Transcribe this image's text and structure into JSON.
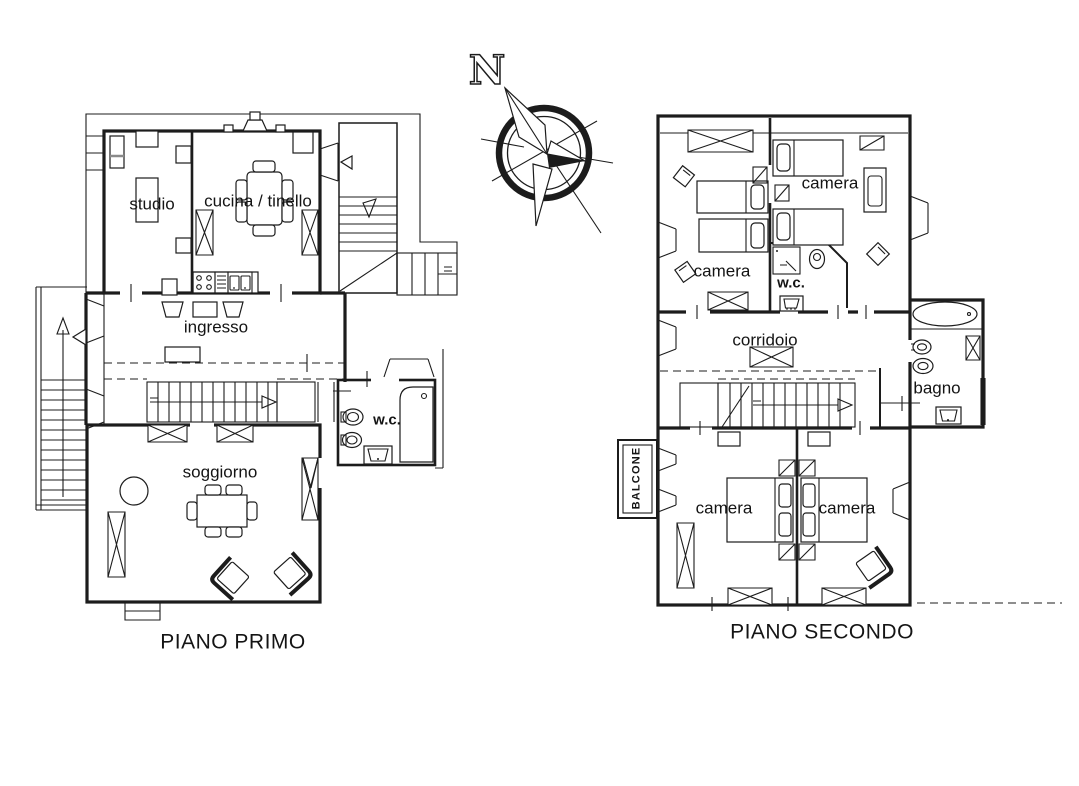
{
  "colors": {
    "line": "#1c1c1c",
    "background": "#ffffff"
  },
  "compass": {
    "north_label": "N"
  },
  "floor_plans": [
    {
      "id": "piano-primo",
      "title": "PIANO PRIMO",
      "rooms": [
        {
          "id": "studio",
          "label": "studio"
        },
        {
          "id": "cucina",
          "label": "cucina / tinello"
        },
        {
          "id": "ingresso",
          "label": "ingresso"
        },
        {
          "id": "wc",
          "label": "w.c."
        },
        {
          "id": "soggiorno",
          "label": "soggiorno"
        }
      ]
    },
    {
      "id": "piano-secondo",
      "title": "PIANO SECONDO",
      "rooms": [
        {
          "id": "camera-nord-ovest",
          "label": "camera"
        },
        {
          "id": "camera-nord-est",
          "label": "camera"
        },
        {
          "id": "wc",
          "label": "w.c."
        },
        {
          "id": "corridoio",
          "label": "corridoio"
        },
        {
          "id": "bagno",
          "label": "bagno"
        },
        {
          "id": "camera-sud-ovest",
          "label": "camera"
        },
        {
          "id": "camera-sud-est",
          "label": "camera"
        },
        {
          "id": "balcone",
          "label": "BALCONE"
        }
      ]
    }
  ]
}
